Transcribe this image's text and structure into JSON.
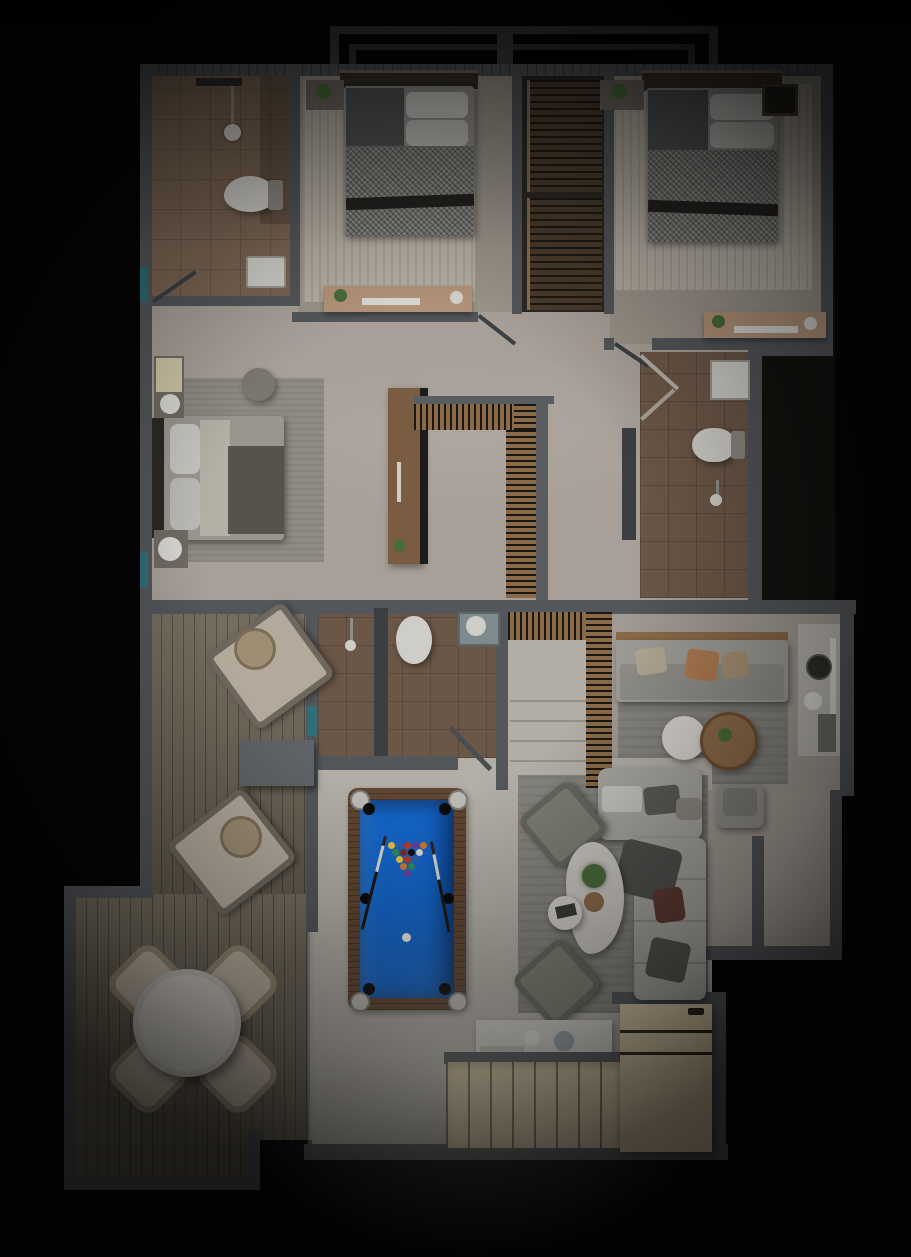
{
  "scene": {
    "type": "architectural-floor-plan-render",
    "view": "top-down",
    "levels": [
      {
        "name": "upper-floor",
        "rooms": [
          {
            "name": "bathroom-1",
            "position": "top-left",
            "furniture": [
              "shower-head",
              "toilet",
              "sink"
            ],
            "floor": "tan-tile"
          },
          {
            "name": "bedroom-1",
            "position": "top-middle",
            "furniture": [
              "double-bed-checkered-blanket",
              "white-pillows",
              "nightstand-with-plant",
              "desk-with-laptop-and-plant"
            ],
            "floor": "striped-rug"
          },
          {
            "name": "wardrobe-closet",
            "position": "top-center",
            "furniture": [
              "slatted-shelf-upper",
              "slatted-shelf-lower"
            ]
          },
          {
            "name": "bedroom-2",
            "position": "top-right",
            "furniture": [
              "double-bed-checkered-blanket",
              "white-pillows",
              "nightstand-with-plant",
              "wall-art-frame",
              "desk-with-laptop-and-plant"
            ],
            "floor": "striped-rug"
          },
          {
            "name": "master-bedroom",
            "position": "middle-left",
            "furniture": [
              "bed-vertical",
              "round-pouf",
              "nightstand-lamp-top",
              "nightstand-lamp-bottom",
              "ac-unit",
              "wood-wardrobe"
            ],
            "floor": "gray-rug"
          },
          {
            "name": "upper-hall",
            "position": "middle",
            "furniture": [
              "stair-void-railing-L-shape"
            ]
          },
          {
            "name": "bathroom-2",
            "position": "middle-right",
            "furniture": [
              "sink",
              "toilet",
              "shower-head",
              "open-double-doors"
            ],
            "floor": "brown-tile"
          }
        ]
      },
      {
        "name": "ground-floor",
        "rooms": [
          {
            "name": "deck-terrace",
            "position": "left",
            "furniture": [
              "lounge-chair-1",
              "wicker-side-table-1",
              "lounge-chair-2",
              "wicker-side-table-2",
              "planter-block",
              "round-dining-table",
              "wicker-dining-chairs-x4"
            ],
            "floor": "wood-planks"
          },
          {
            "name": "bathroom-3",
            "position": "center-top",
            "furniture": [
              "toilet",
              "shower-head",
              "sink-unit",
              "open-door"
            ],
            "floor": "brown-tile"
          },
          {
            "name": "staircase",
            "position": "center",
            "furniture": [
              "slatted-railing-top",
              "slatted-railing-right",
              "treads"
            ]
          },
          {
            "name": "family-room",
            "position": "right-top",
            "furniture": [
              "sofa-with-orange-pillows",
              "white-coffee-table",
              "wood-coffee-table-with-plant",
              "armchair",
              "side-counter-with-burner"
            ],
            "floor": "gray-rug"
          },
          {
            "name": "living-room",
            "position": "center-right",
            "furniture": [
              "l-shaped-sectional-sofa",
              "dark-throw-blanket",
              "maroon-pillow",
              "armchair-olive-1",
              "armchair-olive-2",
              "organic-white-coffee-table",
              "plant",
              "side-table-with-magazines"
            ],
            "floor": "gray-rug"
          },
          {
            "name": "game-area",
            "position": "center",
            "furniture": [
              "pool-table"
            ],
            "floor": "white-marble"
          },
          {
            "name": "kitchen",
            "position": "bottom",
            "furniture": [
              "white-island-counter",
              "cup",
              "glass-sphere",
              "tray",
              "cabinet-row",
              "tall-cabinet-with-drawers"
            ],
            "floor": "white-marble"
          },
          {
            "name": "entry",
            "position": "right",
            "furniture": []
          }
        ]
      }
    ]
  },
  "pool": {
    "felt_color": "#1465c8",
    "frame_color": "#5f4531",
    "ball_colors": [
      "#e8c23a",
      "#2e5fb0",
      "#c0392b",
      "#6b3fa0",
      "#d07a2c",
      "#2e8b57",
      "#7b2d26",
      "#111111",
      "#ddd8d0",
      "#e8c23a",
      "#c0392b",
      "#2e5fb0",
      "#d07a2c",
      "#2e8b57",
      "#6b3fa0"
    ],
    "cue_count": 2,
    "cue_ball": "white",
    "pocket_count": 6
  },
  "colors": {
    "bg": "#050505",
    "wall": "#53565a",
    "wallDark": "#3c3f42",
    "upperFloor": "#9b948a",
    "hallFloor": "#a8a098",
    "rugLight": "#b4ada2",
    "masterRug": "#8e8b84",
    "tileBath": "#7a6553",
    "tileBathDark": "#6b5747",
    "deck": "#6f6758",
    "lowerFloor": "#b3afa7",
    "grayRug": "#86847e",
    "sofa": "#9d9b95",
    "sofaLight": "#a7a59f",
    "poolFelt": "#1465c8",
    "poolFrame": "#5f4531",
    "cabinet": "#d8c6a3",
    "counterWhite": "#d5d2cb",
    "wood": "#8a6a48",
    "woodDark": "#7a5c42",
    "accentTeal": "#2f6e78",
    "plant": "#4a6b3a",
    "whiteObj": "#cfcdc8",
    "pillowOrange": "#ad7950",
    "blanketDark": "#4f514d",
    "maroonPillow": "#5e3a32"
  }
}
